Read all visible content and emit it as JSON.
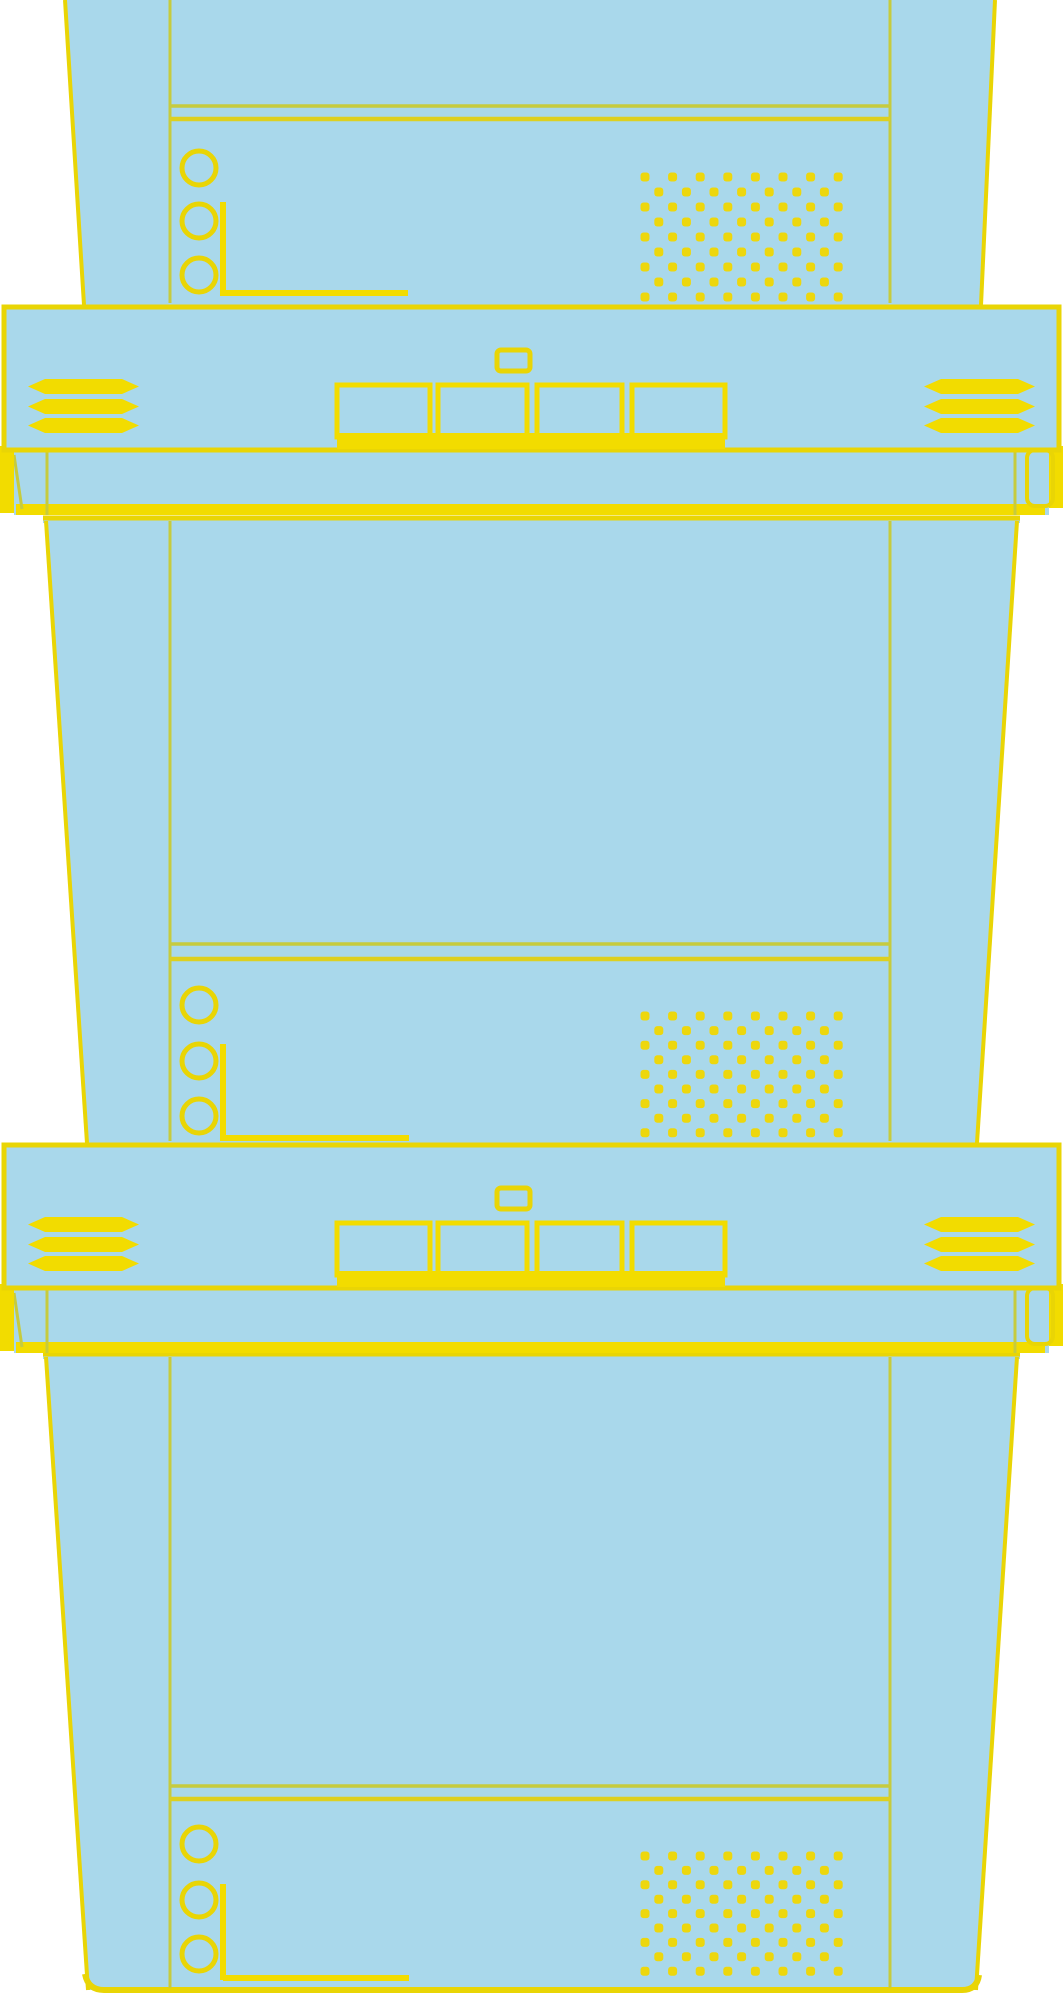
{
  "illustration": {
    "description": "Line-art drawing of three stacked attached-lid storage containers, yellow outlines on light blue fill",
    "canvas": {
      "width": 1063,
      "height": 1995
    },
    "colors": {
      "background": "#ffffff",
      "container_fill": "#a9d8eb",
      "outline_strong": "#e9d505",
      "outline_thin": "#c6cb3e",
      "groove_bright": "#ddd020",
      "accent_solid": "#f2dc00",
      "dot": "#edd70d"
    },
    "containers": [
      {
        "id": "container-top",
        "partial": true,
        "top": 0,
        "bottom": 305,
        "left_edge": {
          "x_top": 65,
          "x_bottom": 84
        },
        "right_edge": {
          "x_top": 995,
          "x_bottom": 981
        },
        "panel_lines_x": [
          170,
          890
        ],
        "groove_lines_y": [
          106,
          119
        ],
        "rivet_circles_y": [
          168,
          221,
          275
        ],
        "bracket": {
          "vline_x": 223,
          "v_from": 202,
          "v_to": 296,
          "hline_y": 293,
          "h_to": 408
        },
        "dots_top_y": 177,
        "dots_row_step": 15.0
      },
      {
        "id": "container-middle",
        "partial": false,
        "rim_y": 516,
        "top": 521,
        "bottom": 1143,
        "left_edge": {
          "x_top": 46,
          "x_bottom": 87
        },
        "right_edge": {
          "x_top": 1017,
          "x_bottom": 977
        },
        "panel_lines_x": [
          170,
          890
        ],
        "groove_lines_y": [
          944,
          959
        ],
        "rivet_circles_y": [
          1005,
          1061,
          1116
        ],
        "bracket": {
          "vline_x": 223,
          "v_from": 1044,
          "v_to": 1141,
          "hline_y": 1138,
          "h_to": 409
        },
        "dots_top_y": 1016,
        "dots_row_step": 14.6
      },
      {
        "id": "container-bottom",
        "partial": false,
        "rounded_bottom": true,
        "rim_y": 1352,
        "top": 1357,
        "bottom": 1990,
        "left_edge": {
          "x_top": 46,
          "x_bottom": 88
        },
        "right_edge": {
          "x_top": 1017,
          "x_bottom": 976
        },
        "panel_lines_x": [
          170,
          890
        ],
        "groove_lines_y": [
          1786,
          1799
        ],
        "rivet_circles_y": [
          1844,
          1900,
          1954
        ],
        "bracket": {
          "vline_x": 223,
          "v_from": 1884,
          "v_to": 1980,
          "hline_y": 1978,
          "h_to": 409
        },
        "dots_top_y": 1856,
        "dots_row_step": 14.4
      }
    ],
    "rivet": {
      "x": 199,
      "radius": 17,
      "stroke": 5
    },
    "dot_grid": {
      "x_start": 645,
      "columns_even": 8,
      "columns_odd": 7,
      "col_step": 27.6,
      "rows": 9,
      "stagger_offset": 13.8,
      "dot_size": 9
    },
    "lids": [
      {
        "id": "lid-upper",
        "top": 305
      },
      {
        "id": "lid-lower",
        "top": 1143
      }
    ],
    "lid_template": {
      "face": {
        "x": 4,
        "width": 1055,
        "height": 143
      },
      "button": {
        "x": 497,
        "y_off": 45,
        "width": 33,
        "height": 21
      },
      "latch_row": {
        "cells": [
          [
            337,
            430
          ],
          [
            438,
            527
          ],
          [
            537,
            622
          ],
          [
            632,
            725
          ]
        ],
        "top_off": 80,
        "cell_height": 52,
        "band_top_off": 128,
        "band_height": 16
      },
      "vents": {
        "y_offsets": [
          74,
          94,
          113
        ],
        "slot_height": 15,
        "left_x": 28,
        "right_x": 924,
        "width": 111,
        "tip": 17
      },
      "skirt": {
        "top_off": 143,
        "bottom_off": 210,
        "inner_lines_x": [
          47,
          1015
        ],
        "band_top_off": 199,
        "band_height": 11,
        "band_x": 16,
        "band_width": 1029,
        "left_foot": {
          "x": 0,
          "width": 14,
          "h": 67
        },
        "right_foot": {
          "x": 1049,
          "width": 14,
          "h": 62
        },
        "right_corner": {
          "x": 1027,
          "width": 26,
          "h": 56
        }
      }
    }
  }
}
